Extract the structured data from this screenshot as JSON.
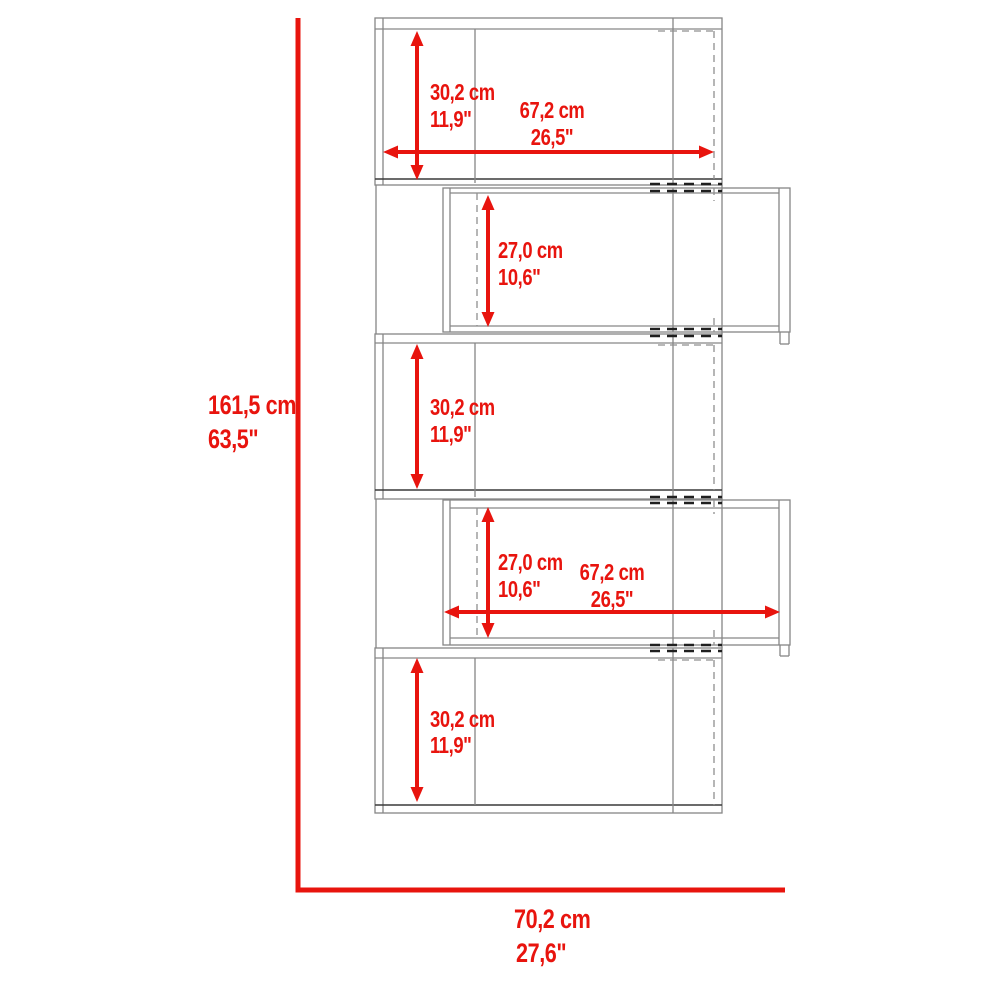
{
  "colors": {
    "dimension_red": "#e8140e",
    "outline_gray": "#868686",
    "outline_dark": "#3a3a3a",
    "background": "#ffffff"
  },
  "overall": {
    "height_cm": "161,5 cm",
    "height_in": "63,5\"",
    "width_cm": "70,2 cm",
    "width_in": "27,6\""
  },
  "compartments": [
    {
      "name": "shelf-1",
      "height_cm": "30,2 cm",
      "height_in": "11,9\"",
      "width_cm": "67,2 cm",
      "width_in": "26,5\""
    },
    {
      "name": "shelf-2",
      "height_cm": "27,0 cm",
      "height_in": "10,6\""
    },
    {
      "name": "shelf-3",
      "height_cm": "30,2 cm",
      "height_in": "11,9\""
    },
    {
      "name": "shelf-4",
      "height_cm": "27,0 cm",
      "height_in": "10,6\"",
      "width_cm": "67,2 cm",
      "width_in": "26,5\""
    },
    {
      "name": "shelf-5",
      "height_cm": "30,2 cm",
      "height_in": "11,9\""
    }
  ]
}
